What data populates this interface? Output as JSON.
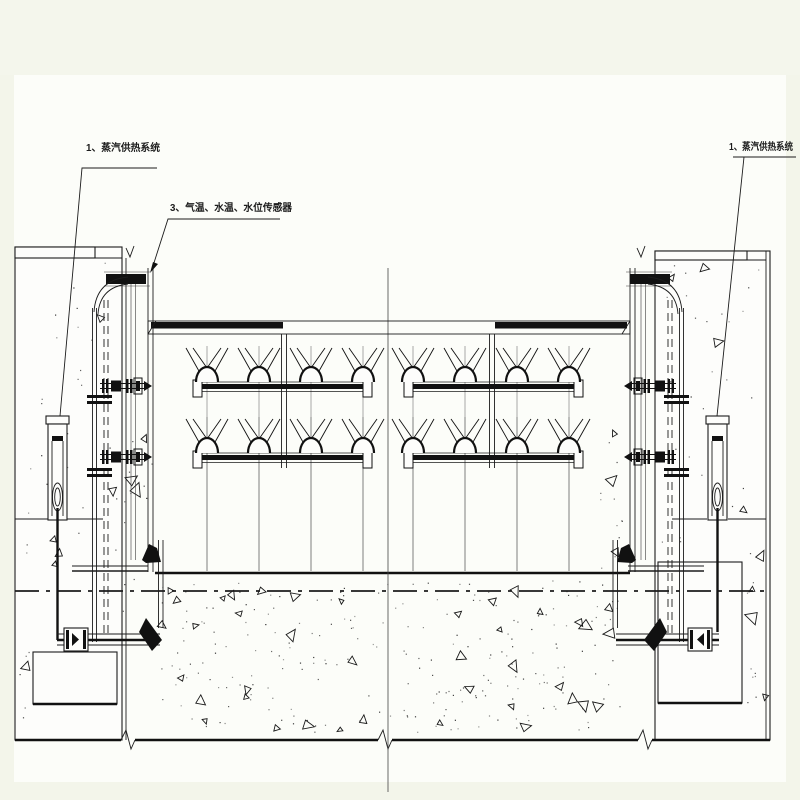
{
  "page": {
    "background": "#f3f5ea",
    "paper": "#fcfdf9",
    "ink": "#1c1c1c",
    "description_type": "engineering-section-drawing"
  },
  "annotations": {
    "steam_supply_left": {
      "text": "1、蒸汽供热系统"
    },
    "sensor_note": {
      "text": "3、气温、水温、水位传感器"
    },
    "steam_supply_right": {
      "text": "1、蒸汽供热系统"
    }
  }
}
